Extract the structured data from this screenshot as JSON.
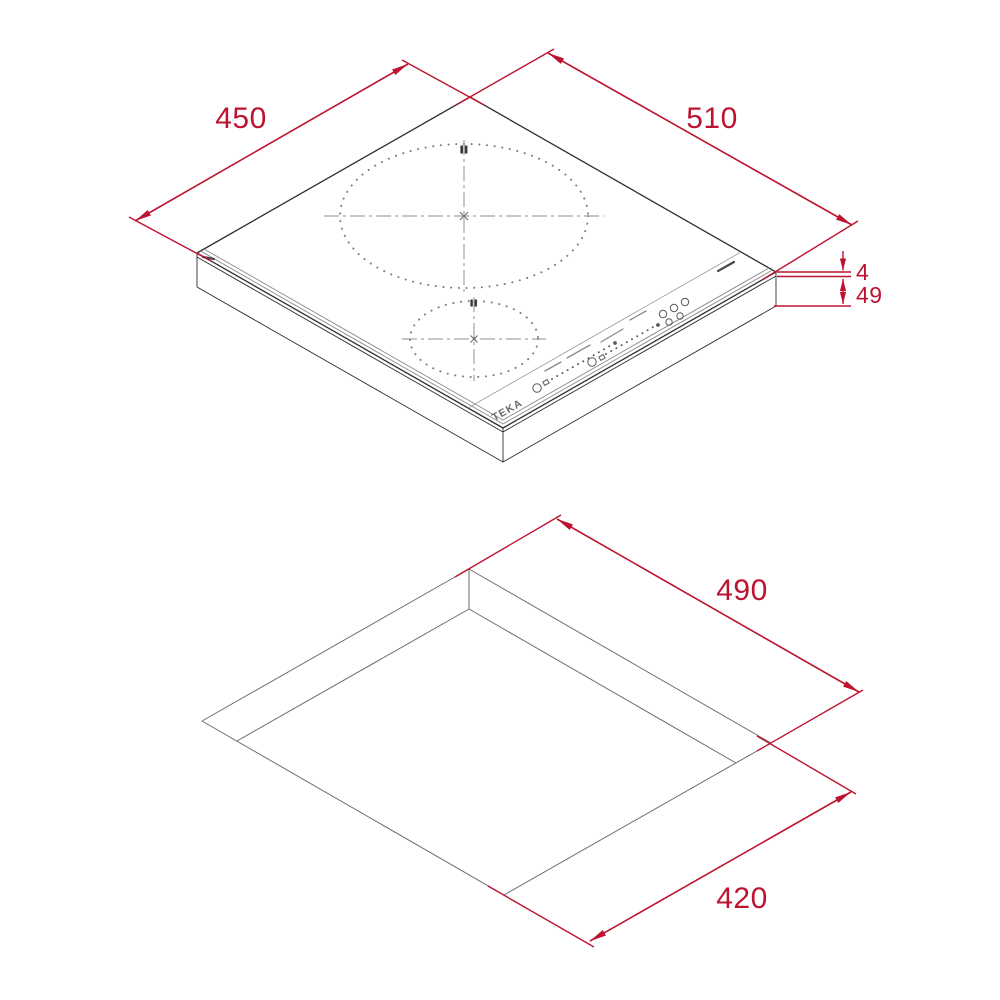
{
  "brand": {
    "logo": "TEKA"
  },
  "colors": {
    "dimension_red": "#BE1330",
    "outline_dark": "#2e2e2e",
    "detail_gray": "#8a8a8a"
  },
  "hob_view": {
    "description": "isometric-view-of-induction-hob",
    "dimensions": {
      "depth_mm": "450",
      "width_mm": "510",
      "glass_thickness_mm": "4",
      "body_height_mm": "49"
    }
  },
  "cutout_view": {
    "description": "worktop-cutout-isometric-view",
    "dimensions": {
      "cutout_width_mm": "490",
      "cutout_depth_mm": "420"
    }
  }
}
